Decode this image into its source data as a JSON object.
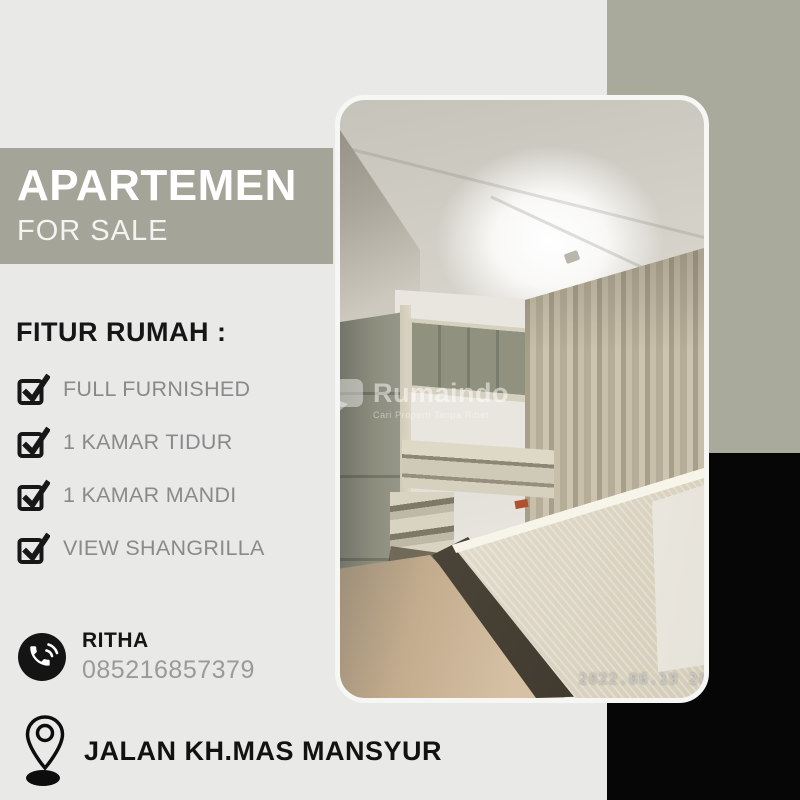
{
  "poster": {
    "banner": {
      "title": "APARTEMEN",
      "subtitle": "FOR SALE"
    },
    "features": {
      "heading": "FITUR RUMAH :",
      "items": [
        "FULL FURNISHED",
        "1 KAMAR TIDUR",
        "1 KAMAR MANDI",
        "VIEW SHANGRILLA"
      ]
    },
    "contact": {
      "name": "RITHA",
      "phone": "085216857379"
    },
    "address": "JALAN KH.MAS MANSYUR"
  },
  "photo": {
    "watermark": {
      "brand": "Rumaindo",
      "tagline": "Cari Properti Tanpa Ribet"
    },
    "timestamp": "2022.06.19 20"
  },
  "colors": {
    "background": "#e9e9e8",
    "sage_block": "#a9aa9b",
    "banner_bg": "#a4a598",
    "black_block": "#060606",
    "title_text": "#ffffff",
    "heading_text": "#161616",
    "feature_text": "#8a8a8a",
    "phone_text": "#9a9a9a"
  },
  "icons": {
    "checkbox": "checkbox-checked-icon",
    "phone": "phone-call-icon",
    "location": "location-pin-icon",
    "brand_logo": "rumaindo-logo-icon"
  }
}
